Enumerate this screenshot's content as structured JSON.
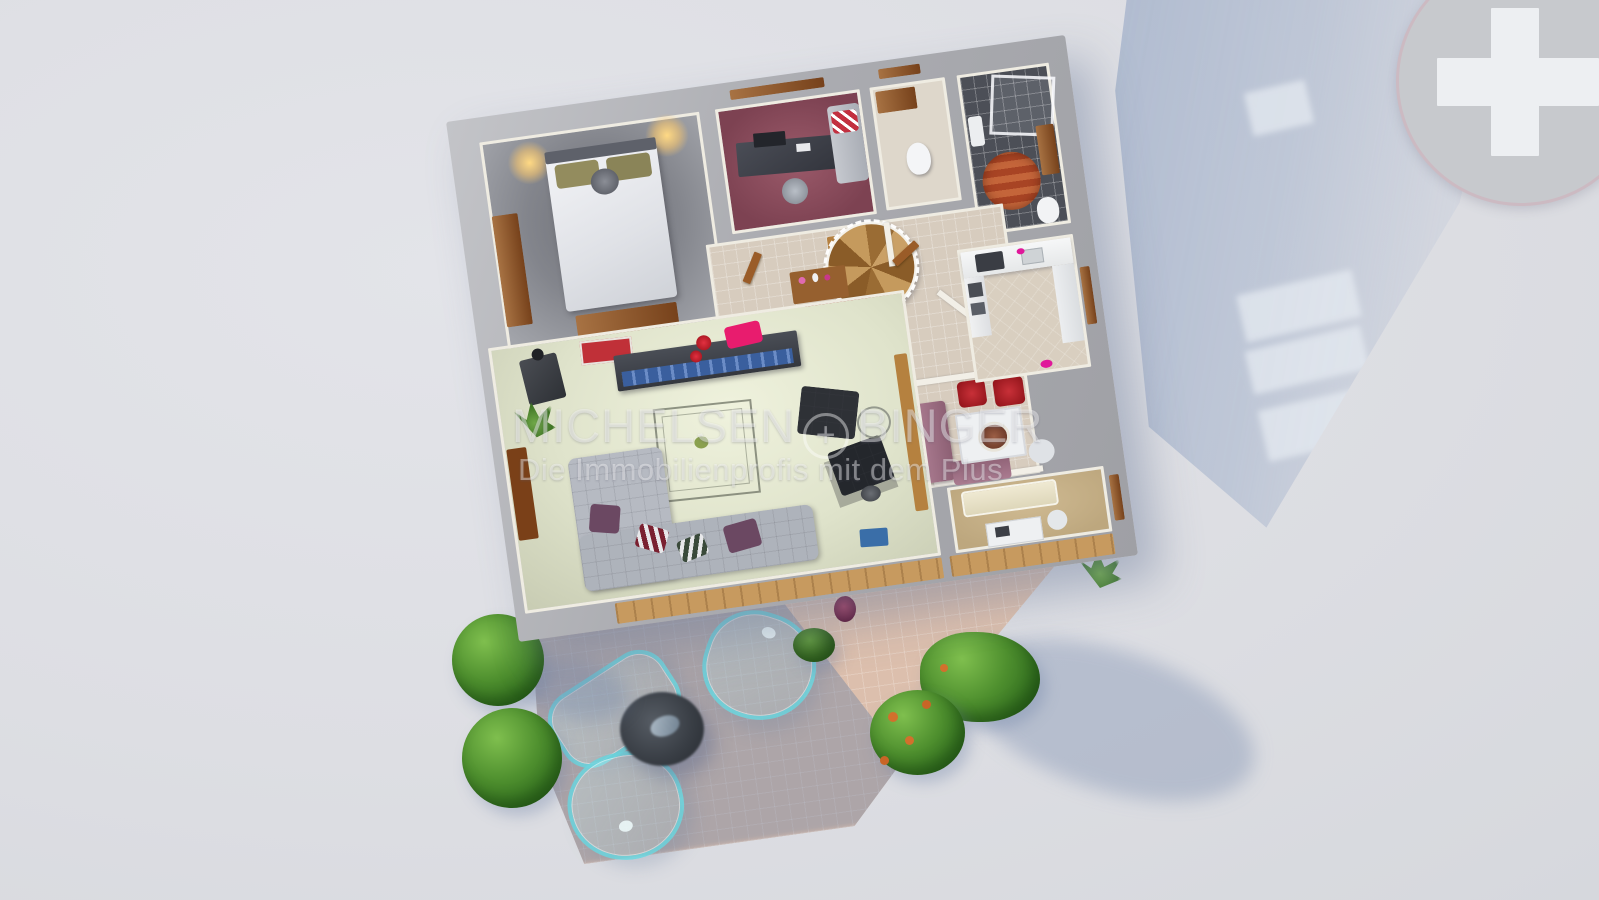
{
  "watermark": {
    "brand_left": "MICHELSEN",
    "plus_glyph": "+",
    "brand_right": "BINGER",
    "tagline": "Die Immobilienprofis mit dem Plus"
  },
  "logo": {
    "symbol": "plus-cross-in-circle"
  },
  "colors": {
    "background": "#dddee3",
    "wall_top": "#aaabb0",
    "inner_wall_face": "#efece2",
    "cast_shadow": "#96a8c6",
    "terrace_tile": "#dcbfad",
    "hall_tile": "#d7ccbe",
    "red_rug": "#a81a0c",
    "office_carpet": "#8a4c5c",
    "bedroom_carpet": "#83858c",
    "living_carpet": "#dfe3cb",
    "bathroom_floor": "#4c4f57",
    "guestroom_carpet": "#c6b088",
    "glass_furniture_accent": "#68d1db",
    "wood": "#8a4f24"
  },
  "rooms": [
    {
      "name": "bedroom"
    },
    {
      "name": "office"
    },
    {
      "name": "wc"
    },
    {
      "name": "bathroom"
    },
    {
      "name": "stair-hall"
    },
    {
      "name": "hallway"
    },
    {
      "name": "kitchen"
    },
    {
      "name": "dining-area"
    },
    {
      "name": "guest-room"
    },
    {
      "name": "living-room"
    },
    {
      "name": "terrace"
    }
  ]
}
